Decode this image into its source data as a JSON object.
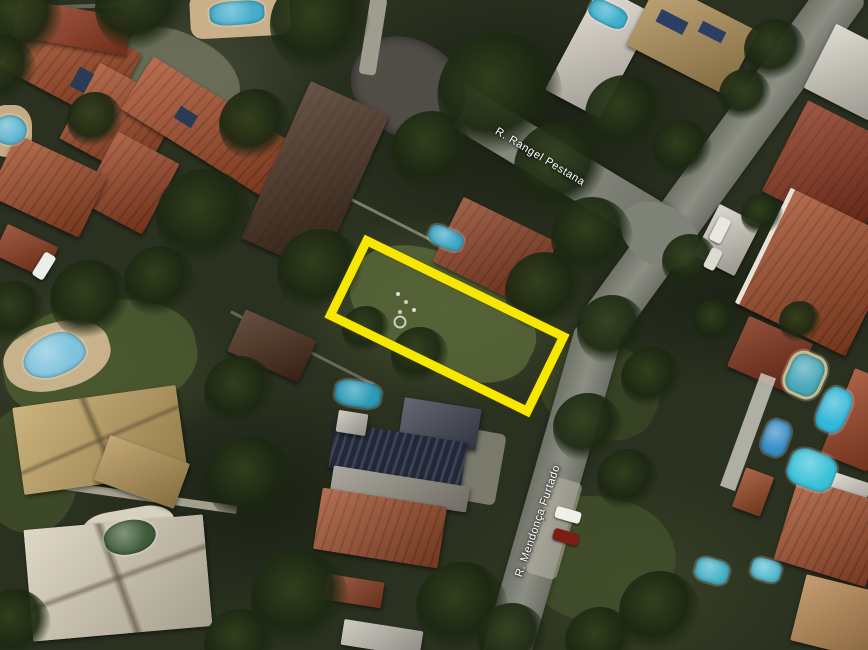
{
  "view": {
    "type": "satellite-aerial-map",
    "description": "Aerial view of residential neighborhood with highlighted vacant lot"
  },
  "streets": {
    "rangel": {
      "label": "R. Rangel Pestana"
    },
    "mendonca": {
      "label": "R. Mendonça Furtado"
    }
  },
  "highlight": {
    "name": "lot-boundary",
    "shape": "rotated-rectangle",
    "color": "#f6e800"
  },
  "palette": {
    "vegetation": "#2a3120",
    "road": "#7f8276",
    "roof_terracotta": "#ab4f2a",
    "roof_dark_red": "#8a331c",
    "roof_dark_brown": "#46301f",
    "roof_tan": "#bfa05e",
    "roof_cream": "#d6cdb8",
    "roof_slate": "#3e4350",
    "roof_white": "#ddd8cc",
    "pool_blue": "#4fb3cf",
    "pool_teal": "#35b8d8",
    "pool_green": "#3f5c3a",
    "highlight_yellow": "#f6e800"
  }
}
